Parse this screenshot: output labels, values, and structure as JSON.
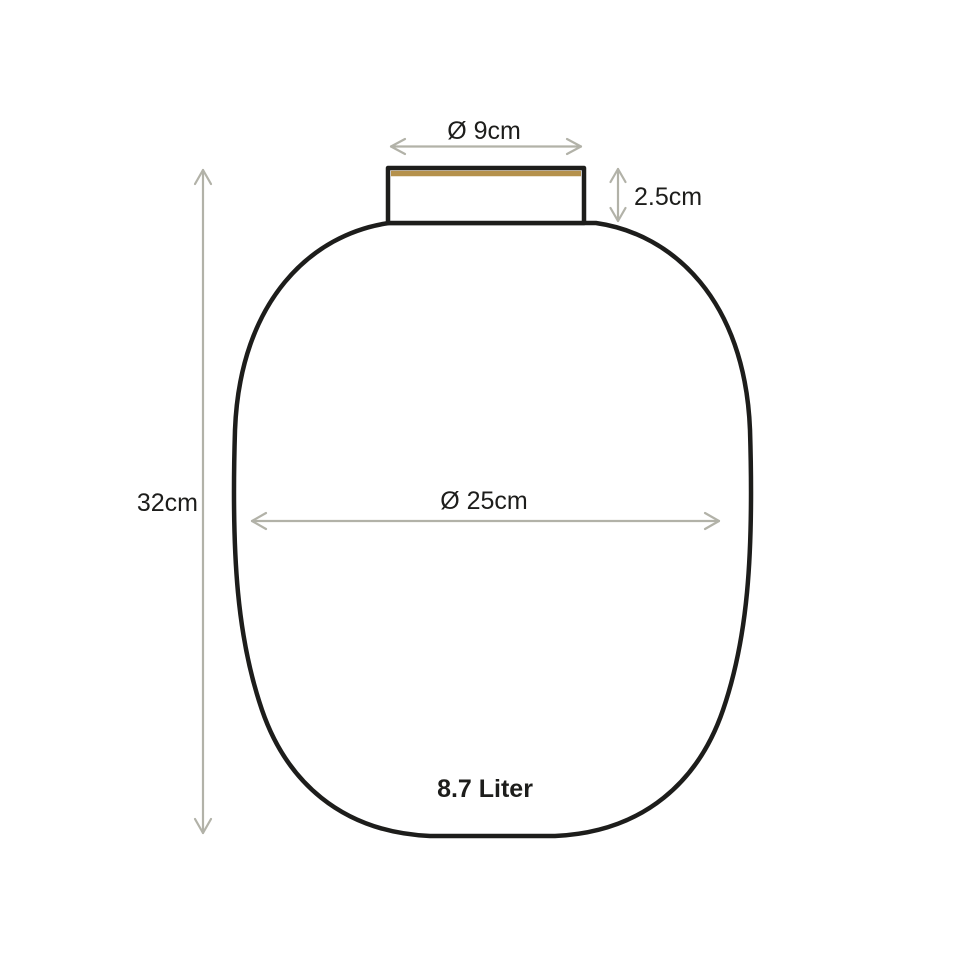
{
  "diagram": {
    "type": "product-dimension-drawing",
    "subject": "vase",
    "labels": {
      "top_diameter": "Ø 9cm",
      "neck_height": "2.5cm",
      "total_height": "32cm",
      "body_diameter": "Ø 25cm",
      "volume": "8.7 Liter"
    },
    "colors": {
      "background": "#ffffff",
      "outline": "#1d1d1b",
      "dimension_arrow": "#b2b2a8",
      "gold_accent": "#b5914c",
      "text": "#1d1d1b"
    }
  }
}
